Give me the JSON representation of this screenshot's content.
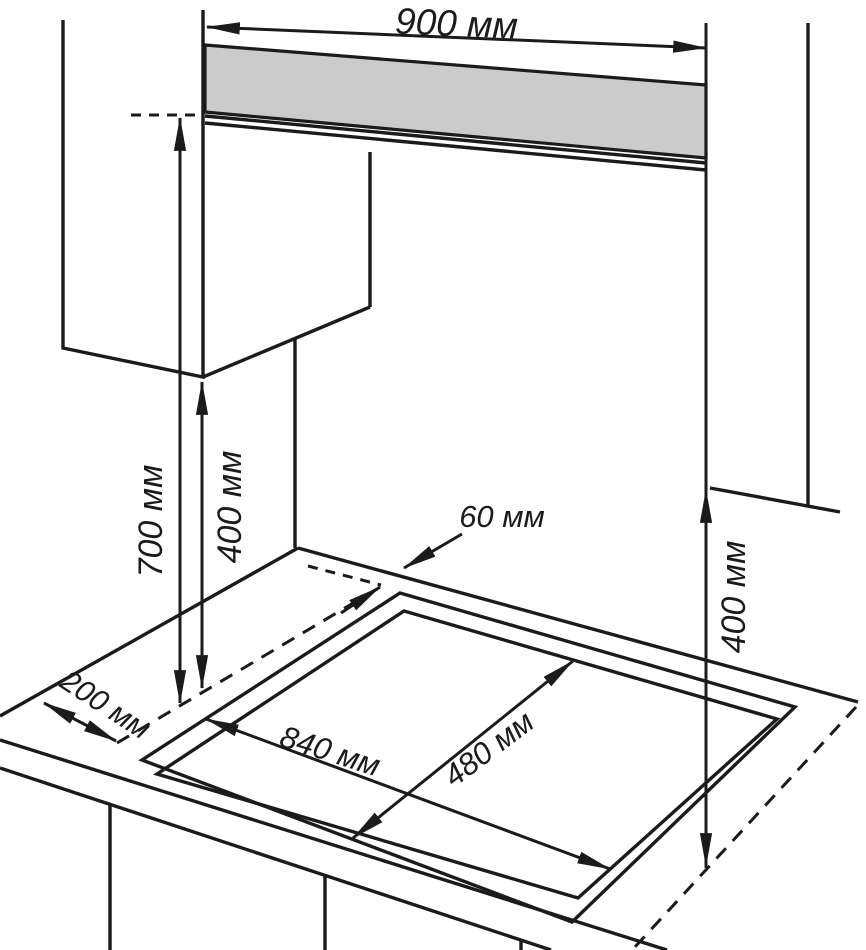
{
  "diagram": {
    "title": "hob-installation-clearances-diagram",
    "units": "мм",
    "labels": {
      "hood_zone_width": "900 мм",
      "hood_height_above_hob": "700 мм",
      "left_cabinet_height_above_hob": "400 мм",
      "wall_to_cutout_gap": "60 мм",
      "left_edge_to_cutout": "200 мм",
      "cutout_width": "840 мм",
      "cutout_depth": "480 мм",
      "right_cabinet_height_above_hob": "400 мм"
    },
    "dimensions_mm": {
      "hood_zone_width": 900,
      "hood_height_above_hob": 700,
      "left_cabinet_height_above_hob": 400,
      "wall_to_cutout_gap": 60,
      "left_edge_to_cutout": 200,
      "cutout_width": 840,
      "cutout_depth": 480,
      "right_cabinet_height_above_hob": 400
    },
    "colors": {
      "line": "#1b1b1b",
      "hood_fill": "#cbcbcb",
      "background": "#ffffff"
    }
  }
}
